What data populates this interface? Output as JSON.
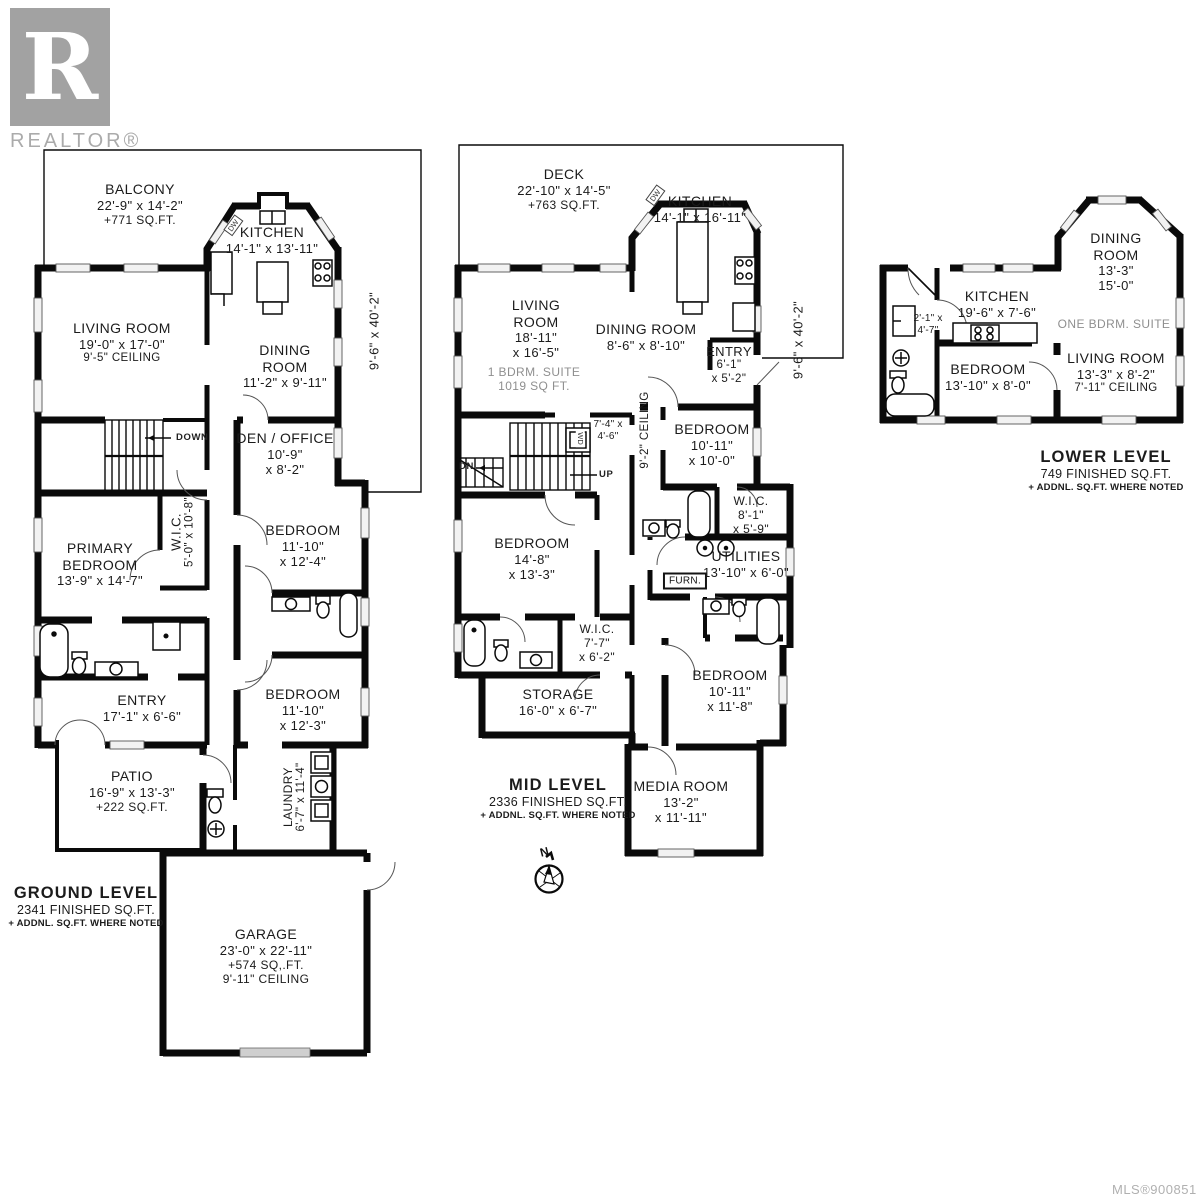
{
  "branding": {
    "logo_letter": "R",
    "logo_text": "REALTOR®"
  },
  "footer": {
    "mls": "MLS®900851"
  },
  "ground": {
    "title": "GROUND LEVEL",
    "finished": "2341 FINISHED SQ.FT.",
    "note": "+ ADDNL. SQ.FT. WHERE NOTED",
    "side_dim": "9'-6\" x 40'-2\"",
    "stairs_label": "DOWN",
    "dw_label": "DW",
    "balcony": [
      "BALCONY",
      "22'-9\" x 14'-2\"",
      "+771 SQ.FT."
    ],
    "kitchen": [
      "KITCHEN",
      "14'-1\" x 13'-11\""
    ],
    "living": [
      "LIVING ROOM",
      "19'-0\" x 17'-0\"",
      "9'-5\" CEILING"
    ],
    "dining": [
      "DINING",
      "ROOM",
      "11'-2\" x 9'-11\""
    ],
    "den": [
      "DEN / OFFICE",
      "10'-9\"",
      "x 8'-2\""
    ],
    "bedroom1": [
      "BEDROOM",
      "11'-10\"",
      "x 12'-4\""
    ],
    "bedroom2": [
      "BEDROOM",
      "11'-10\"",
      "x 12'-3\""
    ],
    "primary": [
      "PRIMARY",
      "BEDROOM",
      "13'-9\" x 14'-7\""
    ],
    "wic": [
      "W.I.C.",
      "5'-0\" x 10'-8\""
    ],
    "entry": [
      "ENTRY",
      "17'-1\" x 6'-6\""
    ],
    "patio": [
      "PATIO",
      "16'-9\" x 13'-3\"",
      "+222 SQ.FT."
    ],
    "laundry": [
      "LAUNDRY",
      "6'-7\" x 11'-4\""
    ],
    "garage": [
      "GARAGE",
      "23'-0\" x 22'-11\"",
      "+574 SQ,.FT.",
      "9'-11\" CEILING"
    ]
  },
  "mid": {
    "title": "MID LEVEL",
    "finished": "2336 FINISHED SQ.FT.",
    "note": "+ ADDNL. SQ.FT. WHERE NOTED",
    "side_dim": "9'-6\" x 40'-2\"",
    "stairs_up": "UP",
    "stairs_dn": "DN",
    "dw_label": "DW",
    "wd_label": "WD",
    "ceiling_note": "9'-2\" CEILING",
    "landing_dim": [
      "7'-4\" x",
      "4'-6\""
    ],
    "deck": [
      "DECK",
      "22'-10\" x 14'-5\"",
      "+763 SQ.FT."
    ],
    "kitchen": [
      "KITCHEN",
      "14'-1\" x 16'-11\""
    ],
    "living": [
      "LIVING",
      "ROOM",
      "18'-11\"",
      "x 16'-5\""
    ],
    "living_note": [
      "1 BDRM. SUITE",
      "1019 SQ FT."
    ],
    "dining": [
      "DINING ROOM",
      "8'-6\" x 8'-10\""
    ],
    "entry": [
      "ENTRY",
      "6'-1\"",
      "x 5'-2\""
    ],
    "bedroom1": [
      "BEDROOM",
      "10'-11\"",
      "x 10'-0\""
    ],
    "wic1": [
      "W.I.C.",
      "8'-1\"",
      "x 5'-9\""
    ],
    "utilities": [
      "UTILITIES",
      "13'-10\" x 6'-0\""
    ],
    "furnace": "FURN.",
    "bedroom2": [
      "BEDROOM",
      "14'-8\"",
      "x 13'-3\""
    ],
    "wic2": [
      "W.I.C.",
      "7'-7\"",
      "x 6'-2\""
    ],
    "storage": [
      "STORAGE",
      "16'-0\" x 6'-7\""
    ],
    "bedroom3": [
      "BEDROOM",
      "10'-11\"",
      "x 11'-8\""
    ],
    "media": [
      "MEDIA ROOM",
      "13'-2\"",
      "x 11'-11\""
    ],
    "compass_n": "N"
  },
  "lower": {
    "title": "LOWER LEVEL",
    "finished": "749 FINISHED SQ.FT.",
    "note": "+ ADDNL. SQ.FT. WHERE NOTED",
    "suite_note": "ONE BDRM. SUITE",
    "dining": [
      "DINING",
      "ROOM",
      "13'-3\"",
      "15'-0\""
    ],
    "kitchen": [
      "KITCHEN",
      "19'-6\" x 7'-6\""
    ],
    "closet": [
      "2'-1\" x",
      "4'-7\""
    ],
    "bedroom": [
      "BEDROOM",
      "13'-10\" x 8'-0\""
    ],
    "living": [
      "LIVING ROOM",
      "13'-3\" x 8'-2\"",
      "7'-11\" CEILING"
    ]
  }
}
